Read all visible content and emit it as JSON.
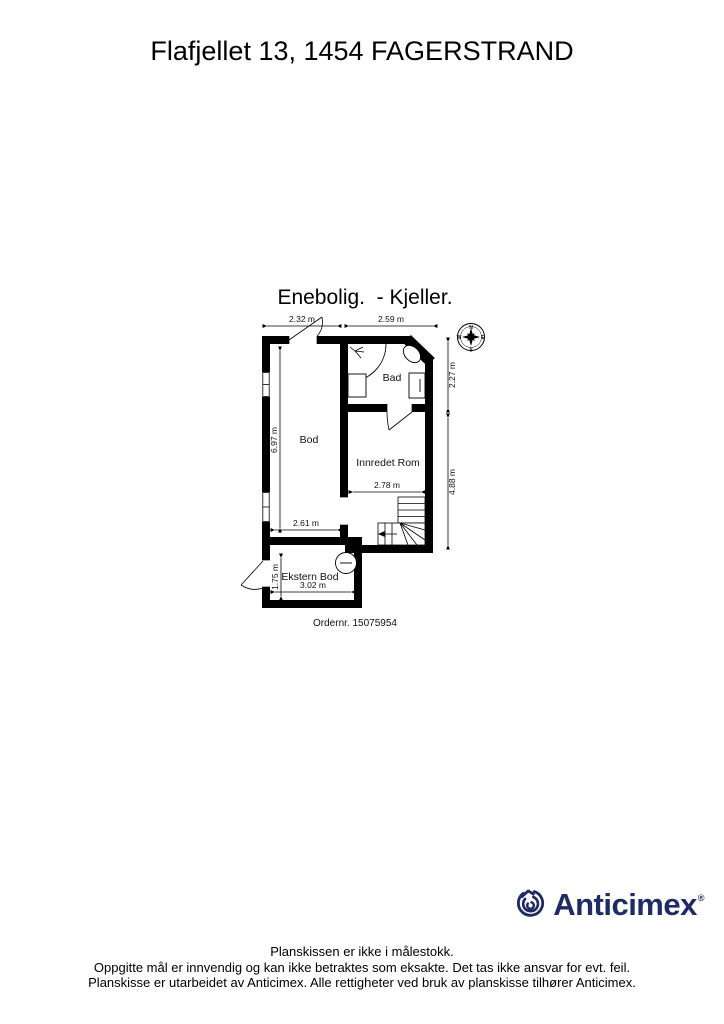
{
  "header": {
    "title": "Flafjellet 13, 1454 FAGERSTRAND"
  },
  "plan": {
    "subtitle": "Enebolig.  - Kjeller.",
    "order_label": "Ordernr. 15075954",
    "rooms": {
      "bod": "Bod",
      "bad": "Bad",
      "innredet": "Innredet Rom",
      "ekstern": "Ekstern Bod"
    },
    "dims": {
      "top_left": "2.32 m",
      "top_right": "2.59 m",
      "bad_height": "2.27 m",
      "innredet_height": "4.88 m",
      "bod_height": "6.97 m",
      "bod_width": "2.61 m",
      "innredet_width": "2.78 m",
      "ekstern_width": "3.02 m",
      "ekstern_height": "1.75 m"
    },
    "compass": {
      "north": "N",
      "east": "E",
      "south": "S",
      "west": "W"
    }
  },
  "branding": {
    "logo_text": "Anticimex",
    "logo_mark": "®",
    "logo_color": "#1e2b66"
  },
  "footer": {
    "line1": "Planskissen er ikke i målestokk.",
    "line2": "Oppgitte mål er innvendig og kan ikke betraktes som eksakte. Det tas ikke ansvar for evt. feil.",
    "line3": "Planskisse er utarbeidet av Anticimex. Alle rettigheter ved bruk av planskisse tilhører Anticimex."
  }
}
